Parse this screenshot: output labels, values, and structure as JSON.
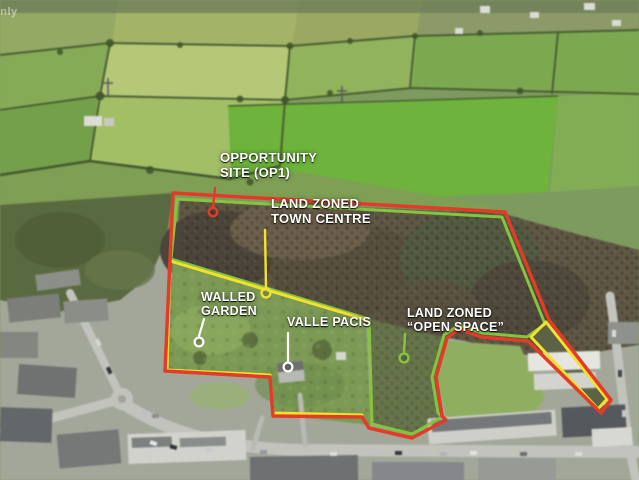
{
  "image": {
    "description": "Aerial photograph of a village-edge development site with land zoning annotation overlay",
    "watermark": "only"
  },
  "colors": {
    "boundary_red": "#e23b27",
    "zoning_green": "#86c440",
    "subarea_yellow": "#f2e22e",
    "leader_white": "#ffffff"
  },
  "annotations": {
    "opportunity_site": {
      "line1": "OPPORTUNITY",
      "line2": "SITE (OP1)",
      "marker_color": "red"
    },
    "land_zoned_town_centre": {
      "line1": "LAND ZONED",
      "line2": "TOWN CENTRE",
      "marker_color": "yellow"
    },
    "walled_garden": {
      "line1": "WALLED",
      "line2": "GARDEN",
      "marker_color": "white"
    },
    "valle_pacis": {
      "line1": "VALLE PACIS",
      "marker_color": "white"
    },
    "land_zoned_open_space": {
      "line1": "LAND ZONED",
      "line2": "“OPEN SPACE”",
      "marker_color": "green"
    }
  }
}
